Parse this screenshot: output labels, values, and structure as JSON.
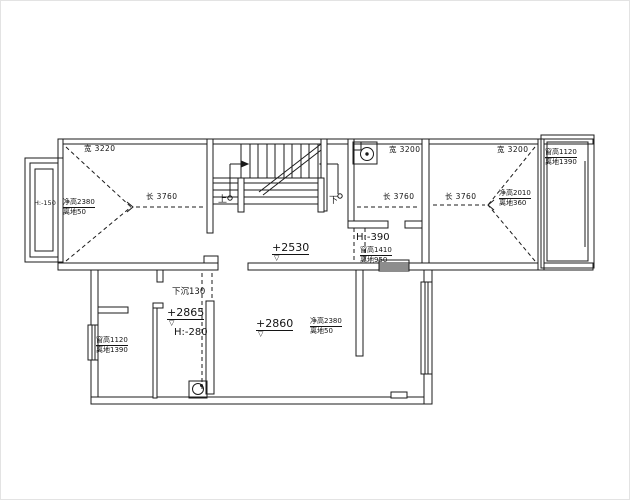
{
  "labels": {
    "tl_width": "宽 3220",
    "tl_depth": "长 3760",
    "tl_clear_height": "净高2380",
    "tl_off_ground": "离地50",
    "bay_left_level": "H:-150",
    "stair_up": "上",
    "stair_down": "下",
    "bath_width": "宽 3200",
    "bath_depth": "长 3760",
    "tr_width": "宽 3200",
    "tr_depth": "长 3760",
    "tr_clear_height": "净高2010",
    "tr_off_ground": "离地360",
    "bay_right_window_height": "窗高1120",
    "bay_right_sill": "离地1390",
    "corridor_level": "+2530",
    "shaft_level": "H:-390",
    "mid_window_height": "窗高1410",
    "mid_window_sill": "离地950",
    "sunken_note": "下沉130",
    "closet_level": "+2865",
    "closet_height": "H:-280",
    "bl_window_height": "窗高1120",
    "bl_window_sill": "离地1390",
    "hall_level": "+2860",
    "hall_clear_height": "净高2380",
    "hall_off_ground": "离地50",
    "level_mark": "▽"
  }
}
